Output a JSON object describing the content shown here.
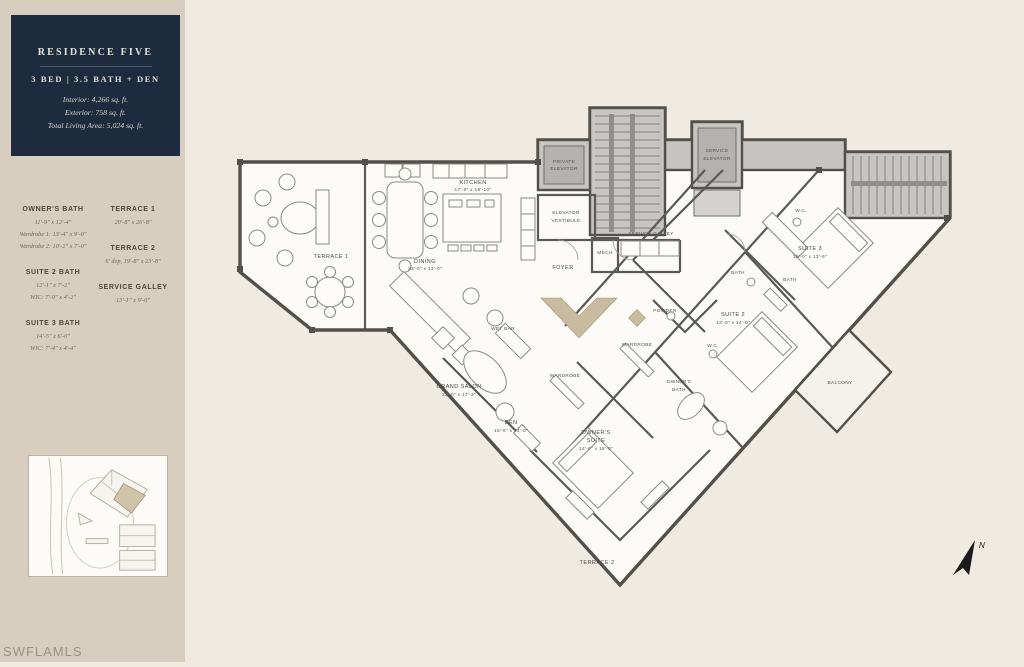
{
  "watermark": "SWFLAMLS",
  "colors": {
    "sidebar_bg": "#d8cec0",
    "main_bg": "#f0ebe2",
    "card_bg": "#1c2c3e",
    "card_text": "#e6e1d4",
    "accent_tan": "#c9bba0",
    "wall": "#52504b"
  },
  "info_card": {
    "title": "RESIDENCE FIVE",
    "subtitle": "3 BED | 3.5 BATH + DEN",
    "stats": [
      "Interior: 4,266 sq. ft.",
      "Exterior: 758 sq. ft.",
      "Total Living Area: 5,024 sq. ft."
    ]
  },
  "legend": {
    "left": [
      {
        "name": "OWNER'S BATH",
        "lines": [
          "11'-9\" x 12'-4\"",
          "Wardrobe 1: 13'-4\" x 9'-0\"",
          "Wardrobe 2: 10'-2\" x 7'-0\""
        ]
      },
      {
        "name": "SUITE 2 BATH",
        "lines": [
          "12'-1\" x 7'-2\"",
          "WIC: 7'-9\" x 4'-2\""
        ]
      },
      {
        "name": "SUITE 3 BATH",
        "lines": [
          "14'-5\" x 6'-0\"",
          "WIC: 7'-4\" x 4'-4\""
        ]
      }
    ],
    "right": [
      {
        "name": "TERRACE 1",
        "lines": [
          "20'-8\" x 26'-8\""
        ]
      },
      {
        "name": "TERRACE 2",
        "lines": [
          "6' dep, 19'-8\" x 23'-8\""
        ]
      },
      {
        "name": "SERVICE GALLEY",
        "lines": [
          "13'-1\" x 9'-0\""
        ]
      }
    ]
  },
  "plan": {
    "terrace1": "TERRACE 1",
    "terrace2": "TERRACE 2",
    "balcony": "BALCONY",
    "kitchen": {
      "name": "KITCHEN",
      "dims": "17'-9\" x 15'-10\""
    },
    "dining": {
      "name": "DINING",
      "dims": "23'-0\" x 13'-0\""
    },
    "grand_salon": {
      "name": "GRAND SALON",
      "dims": "23'-0\" x 17'-3\""
    },
    "den": {
      "name": "DEN",
      "dims": "15'-6\" x 14'-0\""
    },
    "owners_suite": {
      "name1": "OWNER'S",
      "name2": "SUITE",
      "dims": "14'-0\" x 18'-0\""
    },
    "suite2": {
      "name": "SUITE 2",
      "dims": "13'-0\" x 14'-0\""
    },
    "suite3": {
      "name": "SUITE 3",
      "dims": "15'-0\" x 13'-6\""
    },
    "owners_bath": {
      "name1": "OWNER'S",
      "name2": "BATH"
    },
    "private_elevator": {
      "name1": "PRIVATE",
      "name2": "ELEVATOR"
    },
    "service_elevator": {
      "name1": "SERVICE",
      "name2": "ELEVATOR"
    },
    "elevator_vestibule": {
      "name1": "ELEVATOR",
      "name2": "VESTIBULE"
    },
    "foyer": "FOYER",
    "mech": "MECH",
    "service_galley": "SERVICE GALLEY",
    "wet_bar": "WET BAR",
    "powder": "POWDER",
    "wardrobe_a": "WARDROBE",
    "wardrobe_b": "WARDROBE",
    "bath_a": "BATH",
    "bath_b": "BATH",
    "wc_a": "W.C.",
    "wc_b": "W.C.",
    "compass_letter": "N"
  }
}
